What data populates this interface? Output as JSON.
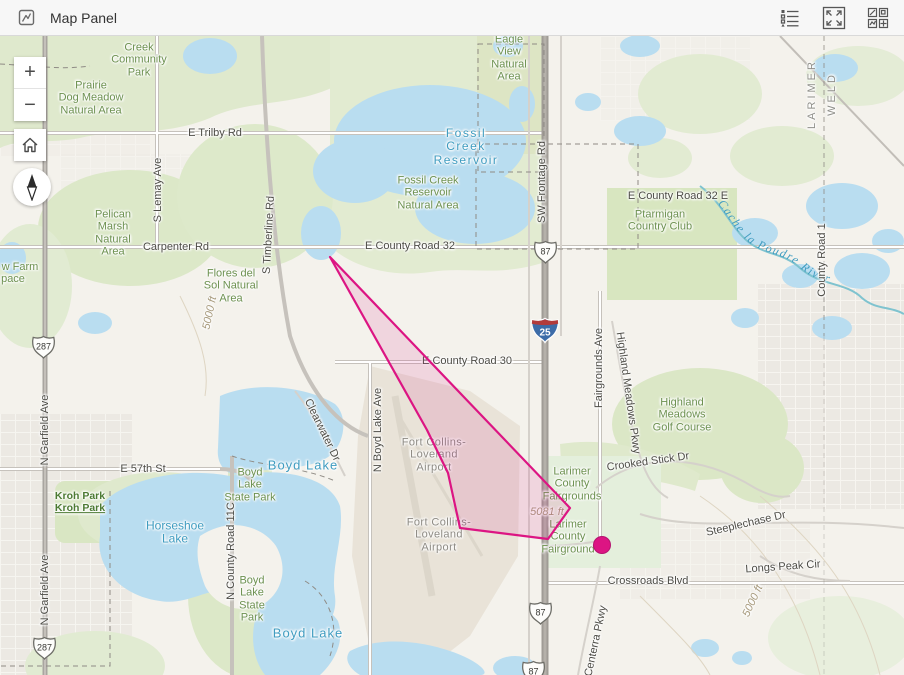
{
  "header": {
    "title": "Map Panel",
    "icons": {
      "left": "map-panel-icon",
      "right": [
        "legend-icon",
        "expand-icon",
        "views-grid-icon"
      ]
    }
  },
  "controls": {
    "zoom_in": "+",
    "zoom_out": "−",
    "home": "home-icon",
    "compass": "compass-needle-icon"
  },
  "map": {
    "river_label": "Cache la Poudre River",
    "overlay": {
      "polygon_points": "330,221 570,472 548,503 460,492 448,437 427,394",
      "polygon_color": "#dc1583",
      "polygon_fill_opacity": 0.13,
      "dot": {
        "x": 602,
        "y": 509,
        "r": 8.5,
        "color": "#dc1583"
      }
    },
    "shields": [
      {
        "type": "us",
        "label": "287",
        "x": 43,
        "y": 311
      },
      {
        "type": "us",
        "label": "287",
        "x": 44,
        "y": 612
      },
      {
        "type": "us",
        "label": "87",
        "x": 545,
        "y": 216
      },
      {
        "type": "us",
        "label": "87",
        "x": 540,
        "y": 577
      },
      {
        "type": "us",
        "label": "87",
        "x": 533,
        "y": 636
      },
      {
        "type": "interstate",
        "label": "25",
        "x": 545,
        "y": 294
      }
    ],
    "labels": [
      {
        "lines": [
          "Creek",
          "Community",
          "Park"
        ],
        "x": 139,
        "y": 24,
        "k": "park"
      },
      {
        "lines": [
          "Prairie",
          "Dog Meadow",
          "Natural Area"
        ],
        "x": 91,
        "y": 62,
        "k": "park"
      },
      {
        "t": "E Trilby Rd",
        "x": 215,
        "y": 97,
        "k": "road"
      },
      {
        "lines": [
          "Eagle",
          "View",
          "Natural",
          "Area"
        ],
        "x": 509,
        "y": 22,
        "k": "park"
      },
      {
        "lines": [
          "Fossil",
          "Creek",
          "Reservoir"
        ],
        "x": 466,
        "y": 111,
        "k": "water",
        "ls": 1.5
      },
      {
        "lines": [
          "Fossil Creek",
          "Reservoir",
          "Natural Area"
        ],
        "x": 428,
        "y": 157,
        "k": "park"
      },
      {
        "t": "SW Frontage Rd",
        "x": 542,
        "y": 146,
        "k": "road",
        "r": -90
      },
      {
        "t": "LARIMER",
        "x": 812,
        "y": 58,
        "k": "county",
        "r": -90
      },
      {
        "t": "WELD",
        "x": 832,
        "y": 58,
        "k": "county",
        "r": -90
      },
      {
        "t": "E County Road 32 E",
        "x": 678,
        "y": 160,
        "k": "road"
      },
      {
        "lines": [
          "Ptarmigan",
          "Country Club"
        ],
        "x": 660,
        "y": 185,
        "k": "park"
      },
      {
        "t": "County Road 1",
        "x": 822,
        "y": 224,
        "k": "road",
        "r": -90
      },
      {
        "lines": [
          "Pelican",
          "Marsh",
          "Natural",
          "Area"
        ],
        "x": 113,
        "y": 197,
        "k": "park"
      },
      {
        "t": "Carpenter Rd",
        "x": 176,
        "y": 211,
        "k": "road"
      },
      {
        "t": "S Lemay Ave",
        "x": 158,
        "y": 154,
        "k": "road",
        "r": -90
      },
      {
        "t": "S Timberline Rd",
        "x": 269,
        "y": 199,
        "k": "road",
        "r": -87
      },
      {
        "lines": [
          "Flores del",
          "Sol Natural",
          "Area"
        ],
        "x": 231,
        "y": 250,
        "k": "park"
      },
      {
        "t": "w Farm",
        "x": 20,
        "y": 231,
        "k": "park"
      },
      {
        "t": "pace",
        "x": 13,
        "y": 243,
        "k": "park"
      },
      {
        "t": "5000 ft",
        "x": 210,
        "y": 277,
        "k": "contour",
        "r": -78
      },
      {
        "t": "E County Road 32",
        "x": 410,
        "y": 210,
        "k": "road"
      },
      {
        "t": "E County Road 30",
        "x": 467,
        "y": 325,
        "k": "road"
      },
      {
        "t": "N Garfield Ave",
        "x": 45,
        "y": 394,
        "k": "road",
        "r": -90
      },
      {
        "t": "N Garfield Ave",
        "x": 45,
        "y": 554,
        "k": "road",
        "r": -90
      },
      {
        "t": "E 57th St",
        "x": 143,
        "y": 433,
        "k": "road"
      },
      {
        "t": "Kroh Park",
        "x": 80,
        "y": 461,
        "k": "parkdark"
      },
      {
        "t": "Kroh Park",
        "x": 80,
        "y": 473,
        "k": "parkdark",
        "u": true
      },
      {
        "lines": [
          "Horseshoe",
          "Lake"
        ],
        "x": 175,
        "y": 497,
        "k": "water"
      },
      {
        "lines": [
          "Boyd",
          "Lake",
          "State Park"
        ],
        "x": 250,
        "y": 449,
        "k": "park"
      },
      {
        "lines": [
          "Boyd",
          "Lake",
          "State",
          "Park"
        ],
        "x": 252,
        "y": 563,
        "k": "park"
      },
      {
        "t": "Boyd Lake",
        "x": 303,
        "y": 430,
        "k": "water",
        "fs": 13,
        "ls": 1
      },
      {
        "t": "Boyd Lake",
        "x": 308,
        "y": 598,
        "k": "water",
        "fs": 13,
        "ls": 1
      },
      {
        "t": "N County Road 11C",
        "x": 231,
        "y": 515,
        "k": "road",
        "r": -90
      },
      {
        "t": "N Boyd Lake Ave",
        "x": 378,
        "y": 394,
        "k": "road",
        "r": -90
      },
      {
        "lines": [
          "Fort Collins-",
          "Loveland",
          "Airport"
        ],
        "x": 434,
        "y": 419,
        "k": "airport"
      },
      {
        "lines": [
          "Fort Collins-",
          "Loveland",
          "Airport"
        ],
        "x": 439,
        "y": 499,
        "k": "airport"
      },
      {
        "lines": [
          "Larimer",
          "County",
          "Fairgrounds"
        ],
        "x": 572,
        "y": 448,
        "k": "park"
      },
      {
        "lines": [
          "Larimer",
          "County",
          "Fairground"
        ],
        "x": 568,
        "y": 501,
        "k": "park"
      },
      {
        "t": "Fairgrounds Ave",
        "x": 599,
        "y": 332,
        "k": "road",
        "r": -90
      },
      {
        "t": "Highland Meadows Pkwy",
        "x": 628,
        "y": 357,
        "k": "road",
        "r": 82
      },
      {
        "lines": [
          "Highland",
          "Meadows",
          "Golf Course"
        ],
        "x": 682,
        "y": 379,
        "k": "park"
      },
      {
        "t": "Crooked Stick Dr",
        "x": 648,
        "y": 426,
        "k": "road",
        "r": -8
      },
      {
        "t": "Steeplechase Dr",
        "x": 746,
        "y": 488,
        "k": "road",
        "r": -13
      },
      {
        "t": "Longs Peak Cir",
        "x": 783,
        "y": 531,
        "k": "road",
        "r": -4
      },
      {
        "t": "Crossroads Blvd",
        "x": 648,
        "y": 545,
        "k": "road"
      },
      {
        "t": "Centerra Pkwy",
        "x": 596,
        "y": 605,
        "k": "road",
        "r": -78
      },
      {
        "t": "5081 ft",
        "x": 547,
        "y": 476,
        "k": "contour"
      },
      {
        "t": "5000 ft",
        "x": 753,
        "y": 565,
        "k": "contour",
        "r": -65
      },
      {
        "t": "Clearwater Dr",
        "x": 322,
        "y": 394,
        "k": "road",
        "r": 64
      }
    ],
    "colors": {
      "land": "#f4f2ec",
      "green": "#dfe9cd",
      "water": "#b9ddf0",
      "highway": "#a09c96",
      "overlay_pink": "#dc1583"
    }
  }
}
